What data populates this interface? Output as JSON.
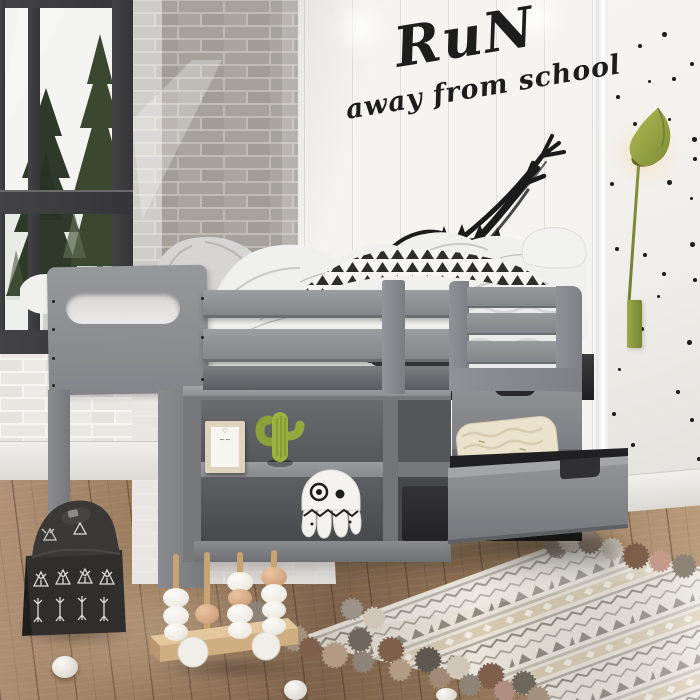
{
  "scene": {
    "kind": "photograph",
    "subject": "Kids bedroom with gray twin loft bed over bookshelf and storage drawers",
    "wall_decal": {
      "line1": "RuN",
      "line2": "away from school",
      "color": "#1d1d1d"
    },
    "palette": {
      "bed_gray": "#8a8b8f",
      "wall_white": "#f5f4f1",
      "brick_gray": "#a7a19b",
      "brick_white": "#eae7e3",
      "polka_dot_black": "#1e1e1e",
      "lamp_olive_green": "#96a544",
      "cactus_green": "#8aa43c",
      "floor_wood_brown": "#8a6c4f",
      "rug_cream": "#ebe6dc",
      "basket_black": "#2f2e2c",
      "bead_peach": "#dbab89",
      "bead_white": "#f3f0ea"
    }
  }
}
